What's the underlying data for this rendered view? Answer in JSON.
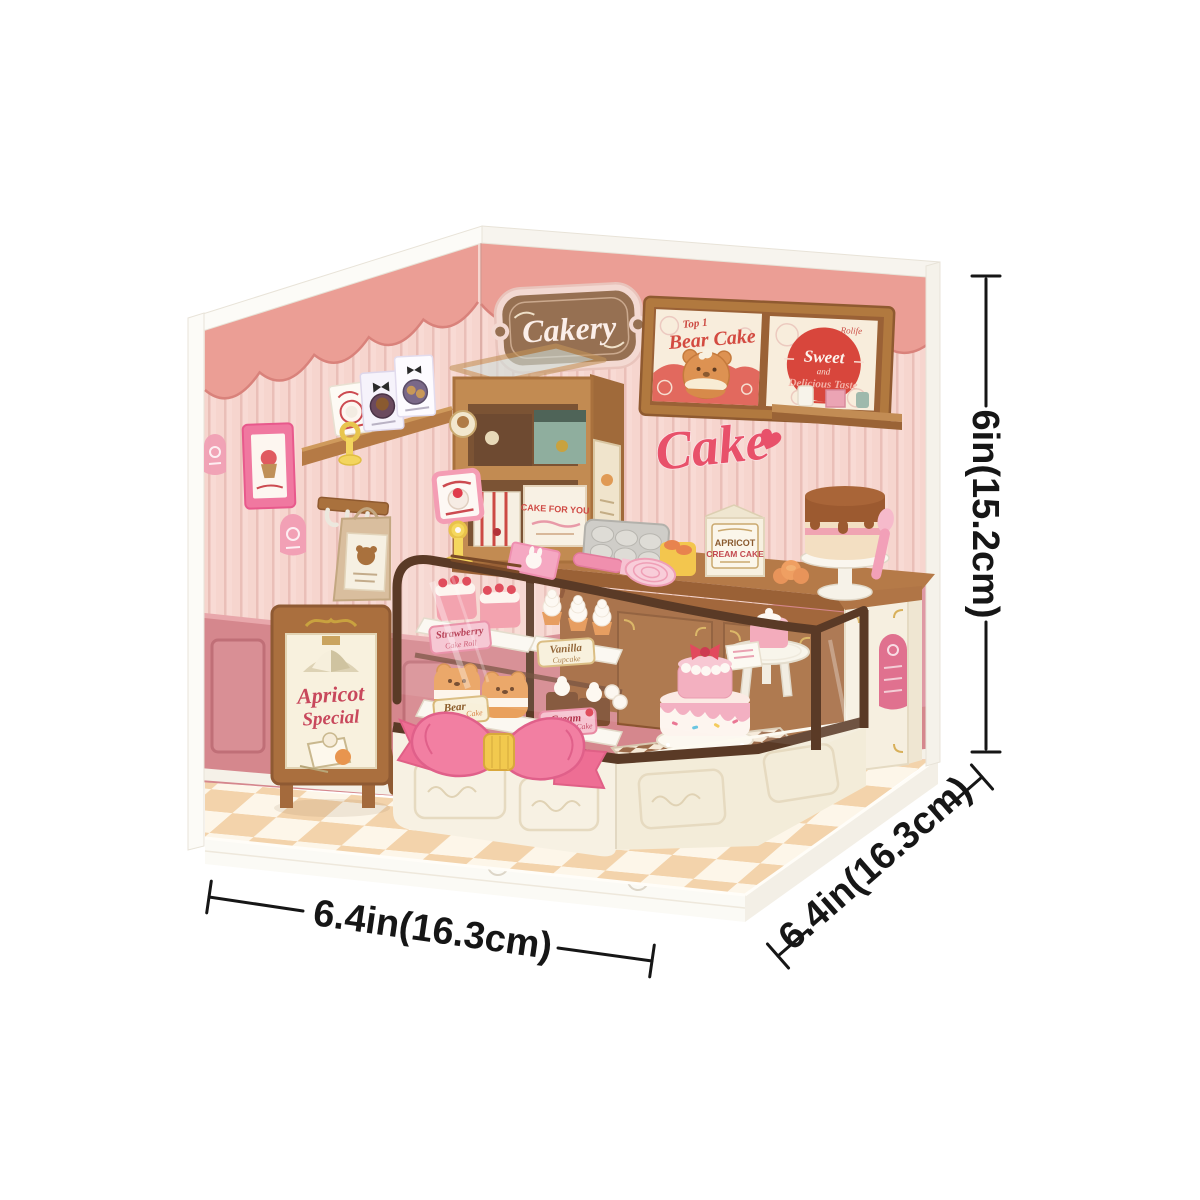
{
  "product_scene": {
    "wall_signs": {
      "cakery": "Cakery",
      "cake_script": "Cake",
      "bear_poster": {
        "tagline": "Top 1",
        "title": "Bear Cake"
      },
      "sweet_poster": {
        "brand": "Rolife",
        "line1": "Sweet",
        "line2": "and",
        "line3": "Delicious Taste"
      }
    },
    "standing_sign": {
      "line1": "Apricot",
      "line2": "Special"
    },
    "packaging": {
      "apricot_box_line1": "APRICOT",
      "apricot_box_line2": "CREAM CAKE",
      "cake_for_you_box": "CAKE FOR YOU"
    },
    "display_labels": {
      "strawberry": {
        "title": "Strawberry",
        "sub": "Cake Roll"
      },
      "vanilla": {
        "title": "Vanilla",
        "sub": "Cupcake"
      },
      "bear": {
        "title": "Bear",
        "sub": "Cake"
      },
      "cream": {
        "title": "Cream",
        "sub": "Cake"
      }
    },
    "dimensions": {
      "front_width": "6.4in(16.3cm)",
      "side_depth": "6.4in(16.3cm)",
      "height": "6in(15.2cm)"
    },
    "colors": {
      "wall_pink": "#f8dad4",
      "scallop_salmon": "#eb9e95",
      "wainscot_rose": "#d5878d",
      "wood": "#b97c48",
      "case_frame_brown": "#5a3a26",
      "accent_pink": "#e8516a",
      "bow_pink": "#f27fa2",
      "floor_cream": "#fdf6e9",
      "floor_peach": "#f2cfa4"
    }
  }
}
